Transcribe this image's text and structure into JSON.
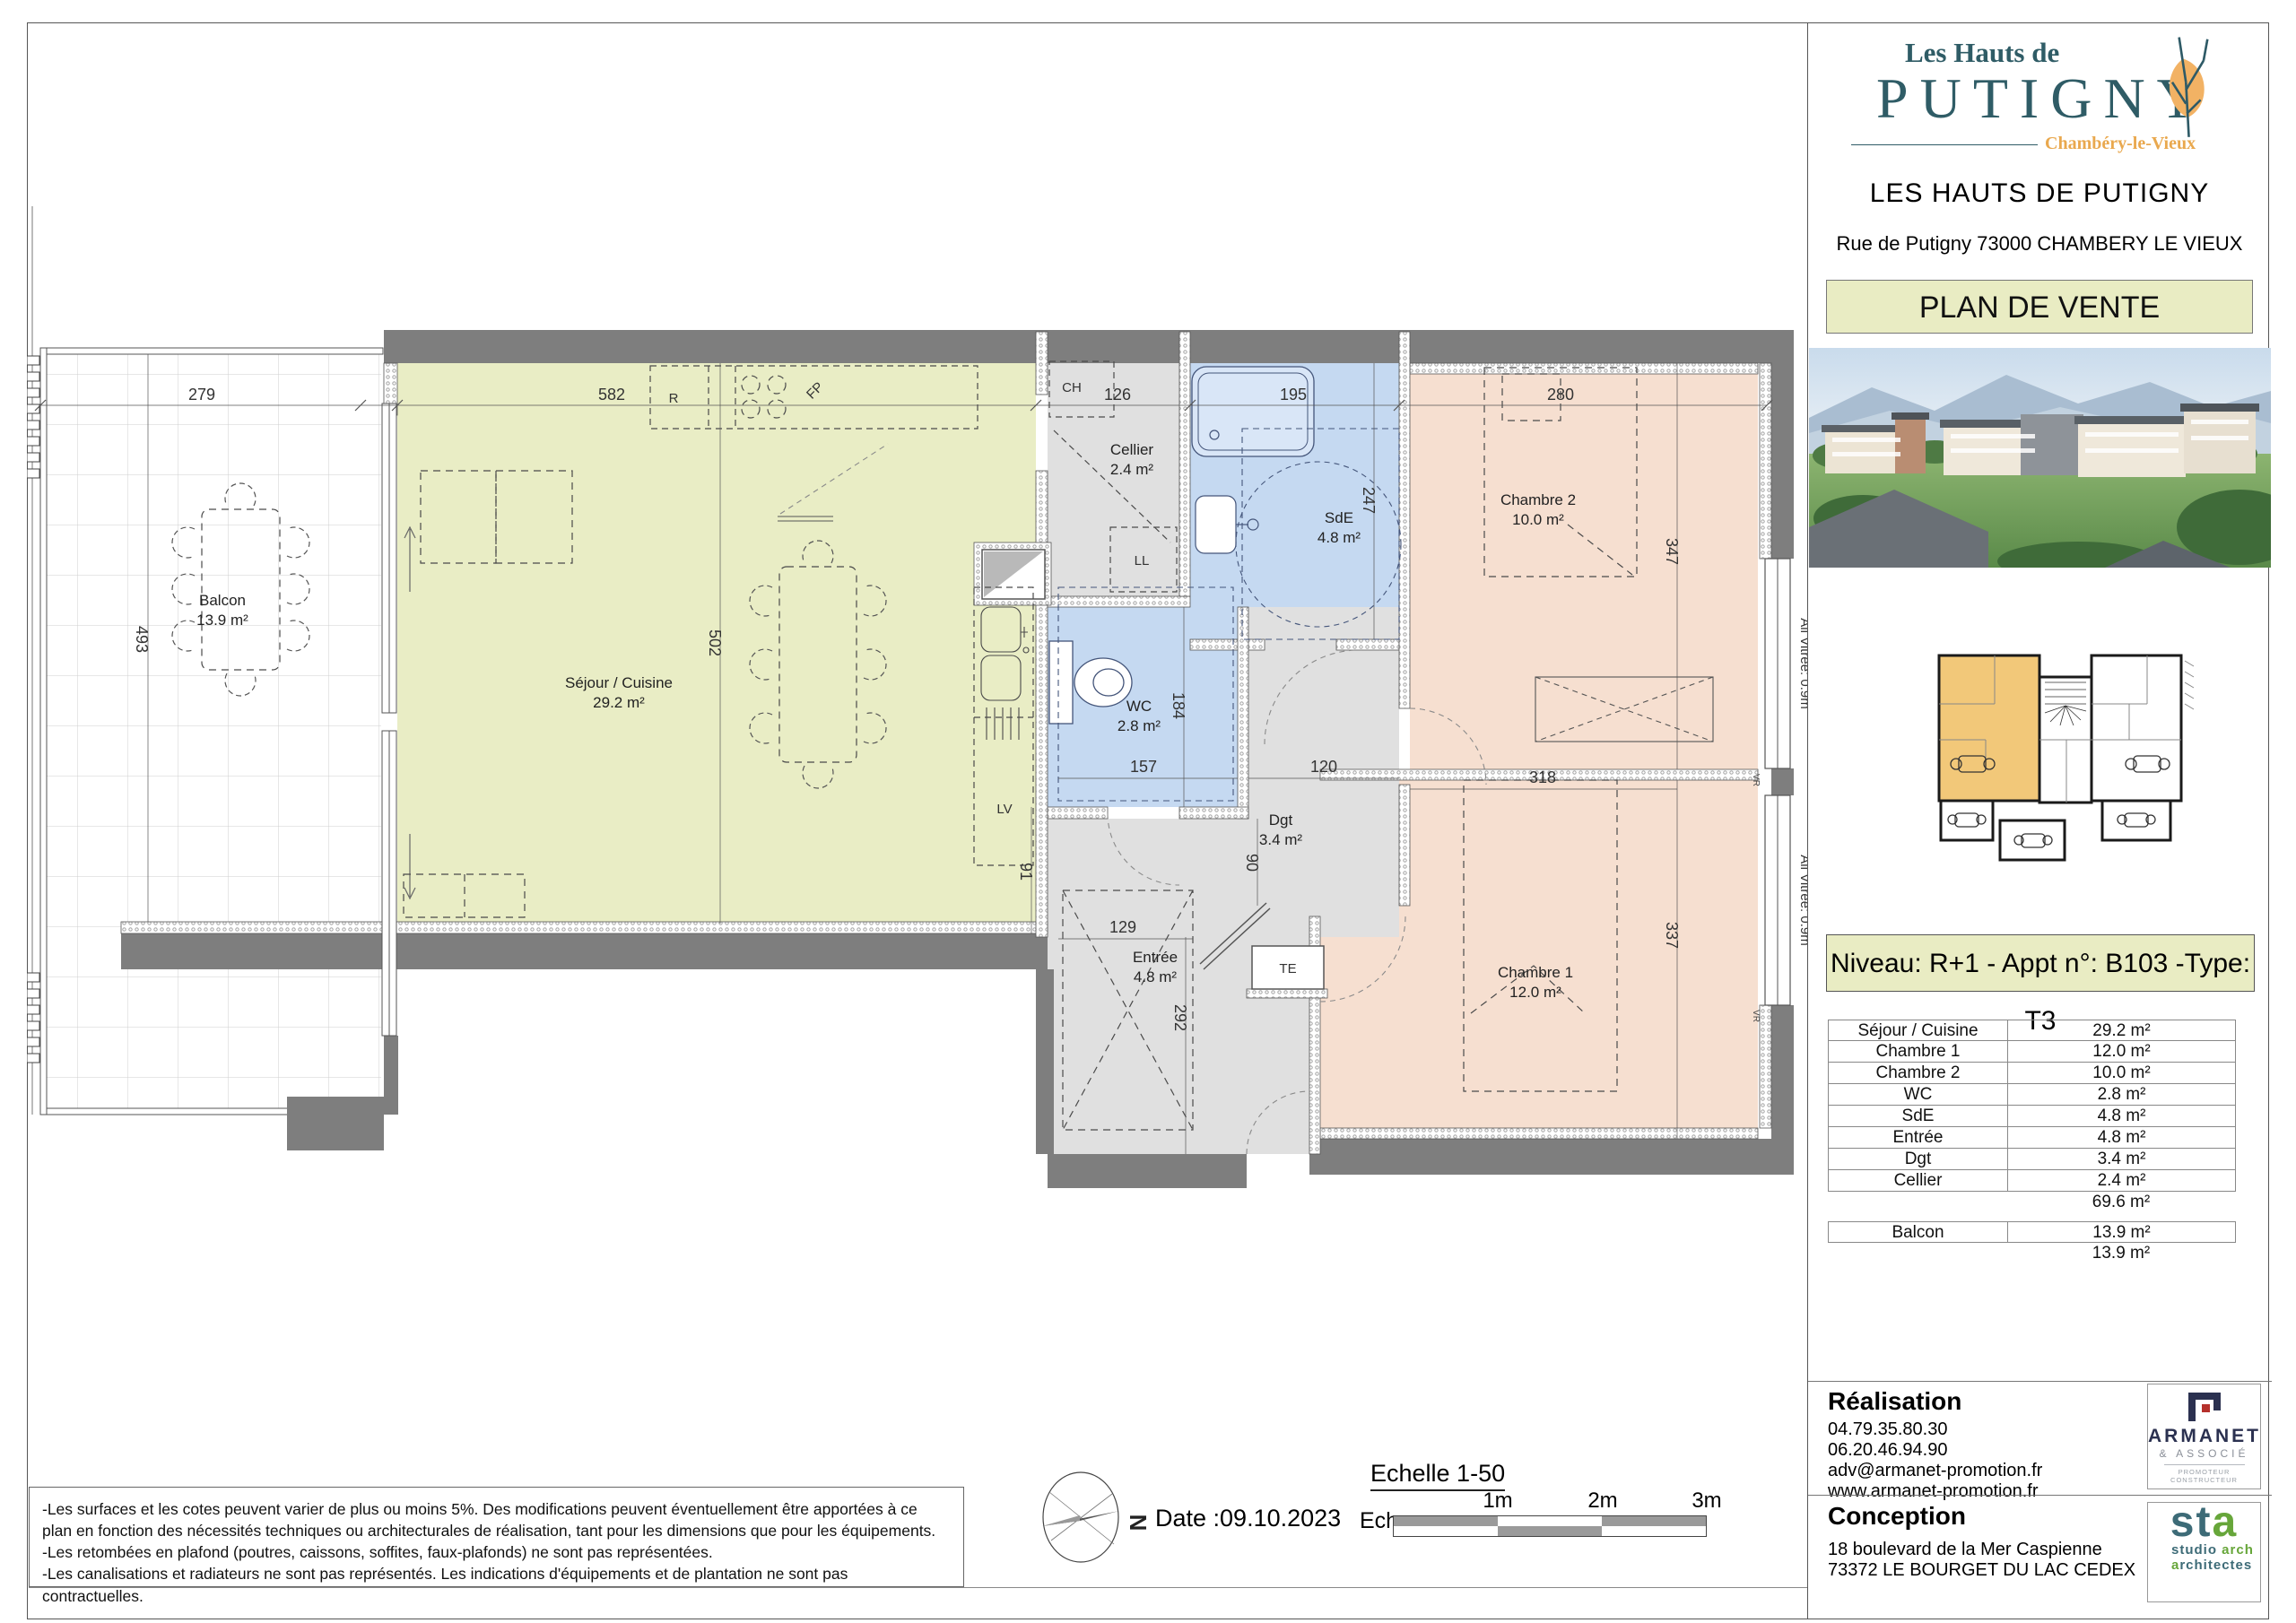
{
  "header": {
    "logo_top": "Les Hauts de",
    "logo_main": "PUTIGNY",
    "logo_sub": "Chambéry-le-Vieux",
    "title": "LES HAUTS DE PUTIGNY",
    "address": "Rue de Putigny 73000 CHAMBERY LE VIEUX",
    "banner": "PLAN DE VENTE"
  },
  "plan": {
    "rooms": {
      "balcon": {
        "name": "Balcon",
        "area": "13.9 m²"
      },
      "sejour": {
        "name": "Séjour / Cuisine",
        "area": "29.2 m²"
      },
      "cellier": {
        "name": "Cellier",
        "area": "2.4 m²"
      },
      "sde": {
        "name": "SdE",
        "area": "4.8 m²"
      },
      "chambre2": {
        "name": "Chambre 2",
        "area": "10.0 m²"
      },
      "wc": {
        "name": "WC",
        "area": "2.8 m²"
      },
      "dgt": {
        "name": "Dgt",
        "area": "3.4 m²"
      },
      "entree": {
        "name": "Entrée",
        "area": "4.8 m²"
      },
      "chambre1": {
        "name": "Chambre 1",
        "area": "12.0 m²"
      }
    },
    "dims": {
      "balcon_w": "279",
      "balcon_h": "493",
      "sejour_w": "582",
      "sejour_h": "502",
      "cellier_w": "126",
      "sde_w": "195",
      "sde_h": "247",
      "ch2_w": "280",
      "ch2_h": "347",
      "wc_w": "157",
      "wc_h": "184",
      "dgt_w": "120",
      "dgt_h": "90",
      "step": "91",
      "entree_w": "129",
      "entree_h": "292",
      "ch1_w": "318",
      "ch1_h": "337"
    },
    "labels": {
      "r": "R",
      "fp": "FP",
      "ch": "CH",
      "ll": "LL",
      "lv": "LV",
      "te": "TE",
      "vr": "VR",
      "vitree": "All Vitrée: 0.9m",
      "north": "N"
    }
  },
  "sidebar": {
    "niveau_banner": "Niveau: R+1  - Appt n°: B103  -Type: T3",
    "table": {
      "rows": [
        {
          "label": "Séjour / Cuisine",
          "value": "29.2 m²"
        },
        {
          "label": "Chambre 1",
          "value": "12.0 m²"
        },
        {
          "label": "Chambre 2",
          "value": "10.0 m²"
        },
        {
          "label": "WC",
          "value": "2.8 m²"
        },
        {
          "label": "SdE",
          "value": "4.8 m²"
        },
        {
          "label": "Entrée",
          "value": "4.8 m²"
        },
        {
          "label": "Dgt",
          "value": "3.4 m²"
        },
        {
          "label": "Cellier",
          "value": "2.4 m²"
        }
      ],
      "total": "69.6 m²",
      "balcon_row": {
        "label": "Balcon",
        "value": "13.9 m²"
      },
      "balcon_total": "13.9 m²"
    },
    "realisation": {
      "title": "Réalisation",
      "phone1": "04.79.35.80.30",
      "phone2": "06.20.46.94.90",
      "email": "adv@armanet-promotion.fr",
      "website": "www.armanet-promotion.fr",
      "logo": {
        "name": "ARMANET",
        "sub": "& ASSOCIÉ",
        "tagline": "PROMOTEUR CONSTRUCTEUR"
      }
    },
    "conception": {
      "title": "Conception",
      "address1": "18 boulevard de la Mer Caspienne",
      "address2": "73372 LE BOURGET DU LAC CEDEX",
      "logo": {
        "big1": "st",
        "big2": "a",
        "line1a": "studio ",
        "line1b": "arch",
        "line2a": "a",
        "line2b": "rchitectes"
      }
    }
  },
  "footer": {
    "disclaimer": [
      "-Les surfaces et les cotes peuvent varier de plus ou moins 5%. Des modifications peuvent éventuellement être apportées à ce plan en fonction des nécessités techniques ou architecturales de réalisation, tant pour les dimensions que pour les équipements.",
      "-Les retombées en plafond (poutres, caissons, soffites, faux-plafonds) ne sont pas représentées.",
      "-Les canalisations et radiateurs ne sont pas représentés. Les indications d'équipements et de plantation ne sont pas contractuelles."
    ],
    "date": "Date :09.10.2023",
    "scale_title": "Echelle 1-50",
    "scale_prefix": "Ech.",
    "scale_marks": [
      "1m",
      "2m",
      "3m"
    ]
  }
}
